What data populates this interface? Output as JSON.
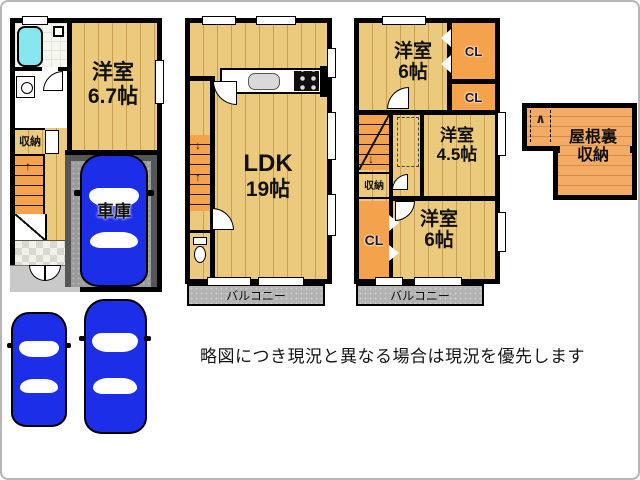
{
  "plan1": {
    "room": {
      "name": "洋室",
      "size": "6.7帖"
    },
    "storage": "収納",
    "garage": "車庫"
  },
  "plan2": {
    "room": {
      "name": "LDK",
      "size": "19帖"
    },
    "balcony": "バルコニー"
  },
  "plan3": {
    "room_top": {
      "name": "洋室",
      "size": "6帖"
    },
    "closet_top": "CL",
    "closet_mid": "CL",
    "room_mid": {
      "name": "洋室",
      "size": "4.5帖"
    },
    "storage": "収納",
    "closet_left": "CL",
    "room_bottom": {
      "name": "洋室",
      "size": "6帖"
    },
    "balcony": "バルコニー"
  },
  "attic": {
    "name_line1": "屋根裏",
    "name_line2": "収納"
  },
  "note": "略図につき現況と異なる場合は現況を優先します",
  "icons": {
    "stairs_up": "↑",
    "stairs_down": "↓",
    "ladder_chevron": "∧"
  },
  "colors": {
    "wall": "#000000",
    "floor": "#ecca7d",
    "closet_orange": "#f4a24b",
    "attic_orange": "#f3ab66",
    "garage_wall": "#565656",
    "garage_floor": "#9b9b9b",
    "balcony_gray": "#b3b3b3",
    "car_blue": "#1c2ee8",
    "bath_cyan": "#86e7ef"
  }
}
